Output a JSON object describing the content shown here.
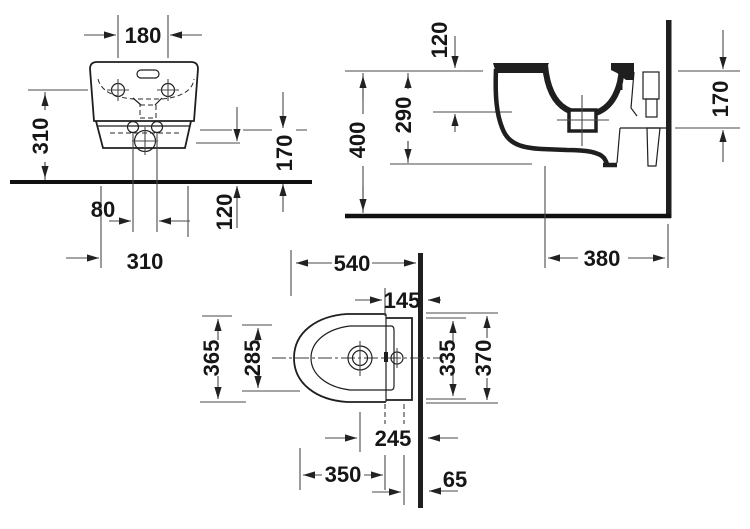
{
  "drawing_title": "bidet-installation-dimension-drawing",
  "units": "mm",
  "colors": {
    "line": "#1f1f1f",
    "dim_line": "#4a4a4a",
    "text": "#161616",
    "background": "#ffffff"
  },
  "front": {
    "d180": "180",
    "d310_left": "310",
    "d170": "170",
    "d120": "120",
    "d80": "80",
    "d310_bottom": "310"
  },
  "side": {
    "d120": "120",
    "d400": "400",
    "d290": "290",
    "d170": "170",
    "d380": "380"
  },
  "top": {
    "d540": "540",
    "d145": "145",
    "d365": "365",
    "d285": "285",
    "d335": "335",
    "d370": "370",
    "d245": "245",
    "d350": "350",
    "d65": "65"
  }
}
